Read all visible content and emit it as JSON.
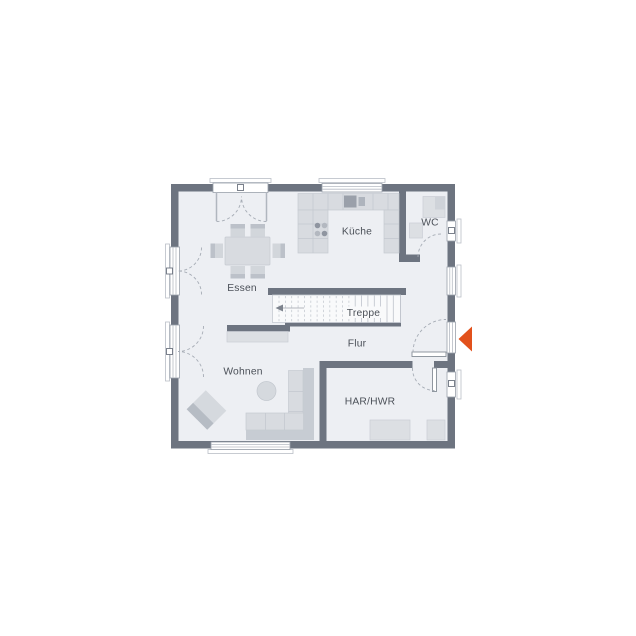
{
  "rooms": {
    "kueche": "Küche",
    "wc": "WC",
    "essen": "Essen",
    "treppe": "Treppe",
    "flur": "Flur",
    "wohnen": "Wohnen",
    "har_hwr": "HAR/HWR"
  },
  "colors": {
    "wall": "#6d7480",
    "floor": "#edeff3",
    "entrance_marker": "#e2511c",
    "label_text": "#4b5058",
    "background": "#ffffff"
  },
  "icons": {
    "entrance_marker": "left-arrow-triangle",
    "stair_direction": "left-arrow"
  }
}
